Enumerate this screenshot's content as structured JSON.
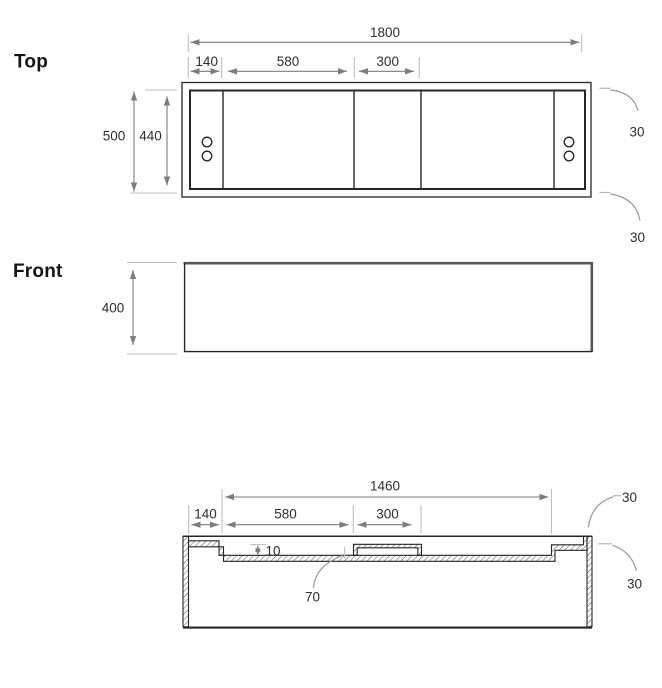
{
  "colors": {
    "line": "#262626",
    "dim": "#7d7d7d",
    "ext": "#bfbfbf",
    "text": "#2e2e2e",
    "leader": "#9a9a9a",
    "hatch": "#3f3f3f",
    "edgegray": "#58585a",
    "bg": "#ffffff"
  },
  "top_view": {
    "title": "Top",
    "dim_overall_width": "1800",
    "dim_left_panel": "140",
    "dim_mid_panel": "580",
    "dim_right_panel": "300",
    "dim_outer_depth": "500",
    "dim_inner_depth": "440",
    "dim_corner_top": "30",
    "dim_corner_bottom": "30"
  },
  "front_view": {
    "title": "Front",
    "dim_height": "400"
  },
  "section_view": {
    "dim_recess_width": "1460",
    "dim_left_ledge": "140",
    "dim_floor_left": "580",
    "dim_plateau": "300",
    "dim_step_depth": "10",
    "dim_drain_offset": "70",
    "dim_corner_top": "30",
    "dim_corner_bottom": "30"
  }
}
